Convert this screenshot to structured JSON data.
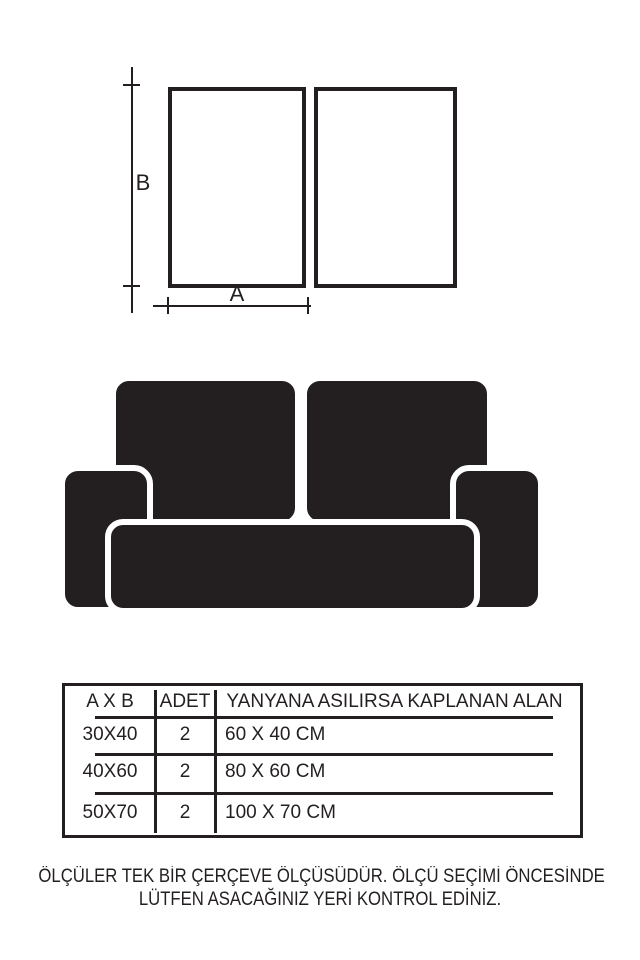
{
  "colors": {
    "ink": "#231f20",
    "background": "#ffffff"
  },
  "diagram": {
    "height_label": "B",
    "width_label": "A"
  },
  "sofa": {
    "icon": "two-seat-sofa-silhouette"
  },
  "table": {
    "headers": [
      "A X B",
      "ADET",
      "YANYANA ASILIRSA KAPLANAN ALAN"
    ],
    "rows": [
      [
        "30X40",
        "2",
        "60 X 40 CM"
      ],
      [
        "40X60",
        "2",
        "80 X 60 CM"
      ],
      [
        "50X70",
        "2",
        "100 X 70 CM"
      ]
    ]
  },
  "note": {
    "line1": "ÖLÇÜLER TEK BİR ÇERÇEVE ÖLÇÜSÜDÜR. ÖLÇÜ SEÇİMİ ÖNCESİNDE",
    "line2": "LÜTFEN ASACAĞINIZ YERİ KONTROL EDİNİZ."
  }
}
